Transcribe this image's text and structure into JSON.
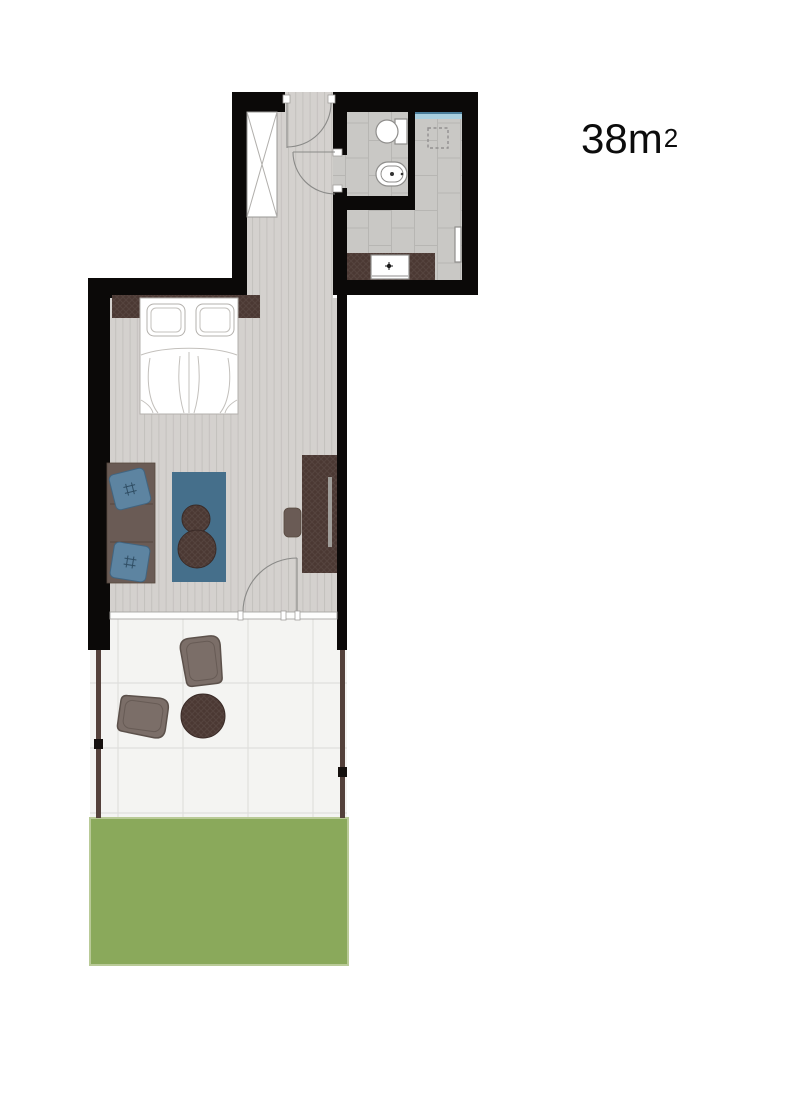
{
  "plan": {
    "area_label": {
      "value": "38m",
      "exponent": "2"
    },
    "rooms": [
      "entrance-hall",
      "bathroom",
      "kitchen",
      "bedroom",
      "living-area",
      "terrace",
      "garden"
    ],
    "furniture": [
      "wardrobe",
      "toilet",
      "bidet",
      "kitchen-counter",
      "kitchen-sink",
      "radiator",
      "headboard",
      "double-bed",
      "bed-pillows",
      "sofa",
      "sofa-cushions",
      "area-rug",
      "pouf-small",
      "pouf-large",
      "tv-sideboard",
      "tv",
      "stool",
      "lounge-chair-1",
      "lounge-chair-2",
      "terrace-table"
    ],
    "colors": {
      "wall": "#0b0908",
      "wood_floor": "#d4d1ce",
      "wood_stripe": "#c4c1be",
      "tile_floor": "#c9c8c5",
      "tile_line": "#b7b6b3",
      "terrace_floor": "#f4f4f2",
      "terrace_line": "#dfdfdd",
      "lawn": "#8aa95b",
      "lawn_edge": "#b9ca97",
      "dark_wood": "#4b3833",
      "dark_wood_edge": "#3a2b27",
      "sofa": "#6a5b55",
      "pillow": "#5d84a1",
      "pillow_edge": "#416581",
      "rug": "#456f8b",
      "chair": "#7b6e68",
      "chair_edge": "#5c514b",
      "post": "#54413b",
      "window_glass": "#a9cede",
      "window_frame": "#4a7d9b",
      "fixture_outline": "#8f8e8c",
      "door_line": "#8a8a88"
    }
  }
}
